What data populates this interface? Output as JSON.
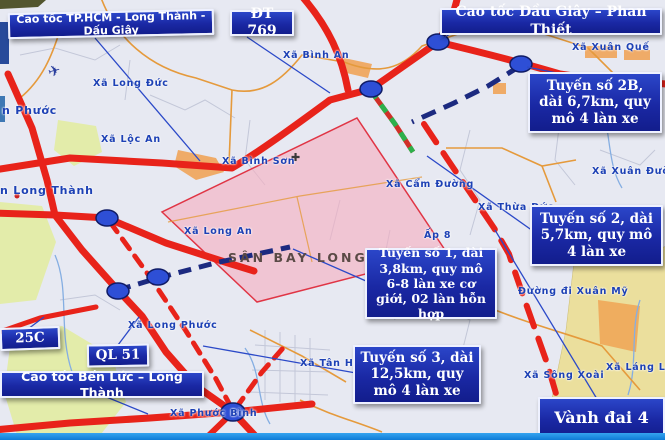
{
  "route_boxes": {
    "hcm_lt_dg": "Cao tốc TP.HCM - Long Thành - Dấu Giây",
    "dt769": "ĐT 769",
    "dg_pt": "Cao tốc Dầu Giây – Phan Thiết",
    "t2b": "Tuyến số 2B, dài 6,7km, quy mô 4 làn xe",
    "t2": "Tuyến số 2, dài 5,7km, quy mô 4 làn xe",
    "t1": "Tuyến số 1, dài 3,8km, quy mô 6-8 làn xe cơ giới, 02 làn hỗn hợp",
    "t3": "Tuyến số 3, dài 12,5km, quy mô 4 làn xe",
    "r25c": "25C",
    "ql51": "QL 51",
    "bl_lt": "Cao tốc Bến Lức – Long Thành",
    "vd4": "Vành đai 4"
  },
  "area_labels": {
    "binh_an": "Xã Bình An",
    "xuan_que": "Xã Xuân Quế",
    "long_duc": "Xã Long Đức",
    "phuoc": "n Phước",
    "loc_an": "Xã Lộc An",
    "binh_son": "Xã Bình Sơn",
    "cam_duong": "Xã Cẩm Đường",
    "xuan_duong": "Xã Xuân Đường",
    "long_thanh": "n Long Thành",
    "long_an": "Xã Long An",
    "thua_duc": "Xã Thừa Đức",
    "ap8": "Ấp 8",
    "long_phuoc": "Xã Long Phước",
    "tan_hiep": "Xã Tân Hiệp",
    "duong_di_xuan_my": "Đường đi Xuân Mỹ",
    "song_xoai": "Xã Sông Xoài",
    "lang_lon": "Xã Láng Lớn",
    "phuoc_binh": "Xã Phước Bình"
  },
  "airport": {
    "name": "SÂN BAY LONG THÀNH"
  },
  "icons": {
    "airplane": "✈",
    "church_cross": "✚"
  },
  "colors": {
    "box_bg": "#1a28a4",
    "box_border": "#ffffff",
    "box_text": "#ffffff",
    "road_red": "#e8231a",
    "planned_navy": "#1c2a80",
    "planned_green": "#2db04b",
    "airport_fill": "#f5afc0",
    "airport_border": "#e03545",
    "area_label_blue": "#1d41b5",
    "map_background": "#e7e9f2",
    "junction_node": "#2e4fd6"
  }
}
